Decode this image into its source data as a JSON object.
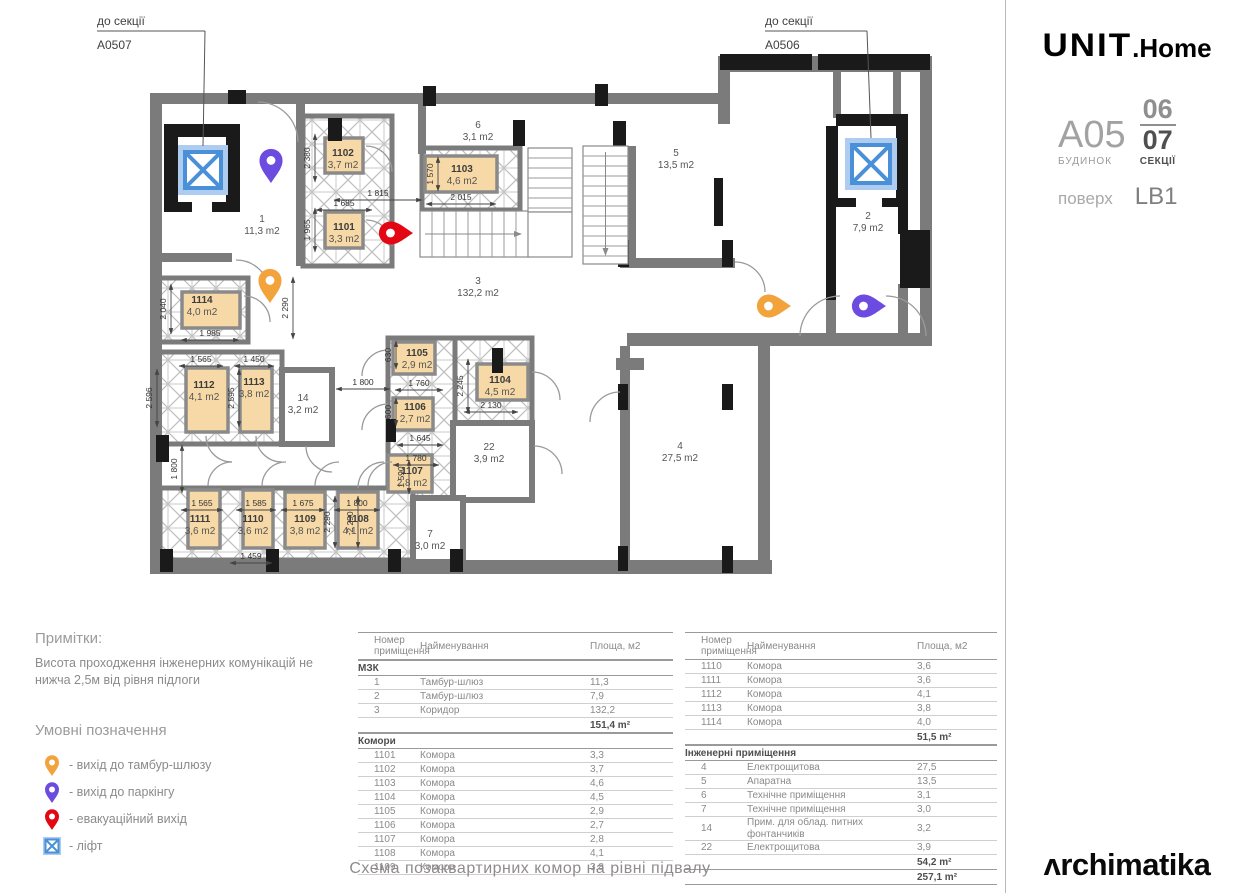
{
  "caption": "Схема позаквартирних комор на рівні підвалу",
  "colors": {
    "pin_orange": "#F2A33C",
    "pin_purple": "#6B4BE0",
    "pin_red": "#E30613",
    "lift_border": "#4A90D9",
    "lift_fill": "#AECBF0",
    "storage_fill": "#F6D9A6",
    "wall_gray": "#7B7B7B",
    "highlight": "#EF8763"
  },
  "notes": {
    "title": "Примітки:",
    "body": "Висота проходження інженерних комунікацій не нижча 2,5м від рівня підлоги"
  },
  "legend": {
    "title": "Умовні позначення",
    "items": [
      {
        "icon": "pin-orange",
        "label": "- вихід до тамбур-шлюзу"
      },
      {
        "icon": "pin-purple",
        "label": "- вихід до паркінгу"
      },
      {
        "icon": "pin-red",
        "label": "- евакуаційний вихід"
      },
      {
        "icon": "lift",
        "label": "- ліфт"
      }
    ]
  },
  "plan": {
    "leaders": [
      {
        "l1": "до секції",
        "l2": "A0507",
        "x": 97,
        "y": 25,
        "ux": 108,
        "tx": 203,
        "ty": 146
      },
      {
        "l1": "до секції",
        "l2": "A0506",
        "x": 765,
        "y": 25,
        "ux": 102,
        "tx": 871,
        "ty": 138
      }
    ],
    "rooms": [
      {
        "id": "1",
        "area": "11,3 m2",
        "x": 262,
        "y": 222
      },
      {
        "id": "2",
        "area": "7,9 m2",
        "x": 868,
        "y": 219
      },
      {
        "id": "3",
        "area": "132,2 m2",
        "x": 478,
        "y": 284
      },
      {
        "id": "4",
        "area": "27,5 m2",
        "x": 680,
        "y": 449
      },
      {
        "id": "5",
        "area": "13,5 m2",
        "x": 676,
        "y": 156
      },
      {
        "id": "6",
        "area": "3,1 m2",
        "x": 478,
        "y": 128
      },
      {
        "id": "7",
        "area": "3,0 m2",
        "x": 430,
        "y": 537
      },
      {
        "id": "14",
        "area": "3,2 m2",
        "x": 303,
        "y": 401
      },
      {
        "id": "22",
        "area": "3,9 m2",
        "x": 489,
        "y": 450
      },
      {
        "id": "1101",
        "area": "3,3 m2",
        "x": 344,
        "y": 230,
        "bold": true
      },
      {
        "id": "1102",
        "area": "3,7 m2",
        "x": 343,
        "y": 156,
        "bold": true
      },
      {
        "id": "1103",
        "area": "4,6 m2",
        "x": 462,
        "y": 172,
        "bold": true
      },
      {
        "id": "1104",
        "area": "4,5 m2",
        "x": 500,
        "y": 383,
        "bold": true
      },
      {
        "id": "1105",
        "area": "2,9 m2",
        "x": 417,
        "y": 356,
        "bold": true
      },
      {
        "id": "1106",
        "area": "2,7 m2",
        "x": 415,
        "y": 410,
        "bold": true
      },
      {
        "id": "1107",
        "area": "2,8 m2",
        "x": 412,
        "y": 474,
        "bold": true
      },
      {
        "id": "1108",
        "area": "4,1 m2",
        "x": 358,
        "y": 522,
        "bold": true
      },
      {
        "id": "1109",
        "area": "3,8 m2",
        "x": 305,
        "y": 522,
        "bold": true
      },
      {
        "id": "1110",
        "area": "3,6 m2",
        "x": 253,
        "y": 522,
        "bold": true
      },
      {
        "id": "1111",
        "area": "3,6 m2",
        "x": 200,
        "y": 522,
        "bold": true
      },
      {
        "id": "1112",
        "area": "4,1 m2",
        "x": 204,
        "y": 388,
        "bold": true
      },
      {
        "id": "1113",
        "area": "3,8 m2",
        "x": 254,
        "y": 385,
        "bold": true
      },
      {
        "id": "1114",
        "area": "4,0 m2",
        "x": 202,
        "y": 303,
        "bold": true
      }
    ],
    "dimensions": [
      {
        "text": "1 815",
        "x": 378,
        "y": 196,
        "rot": 0,
        "len": 88
      },
      {
        "text": "1 570",
        "x": 433,
        "y": 174,
        "rot": -90,
        "len": 34
      },
      {
        "text": "2 015",
        "x": 461,
        "y": 200,
        "rot": 0,
        "len": 70
      },
      {
        "text": "1 685",
        "x": 344,
        "y": 206,
        "rot": 0,
        "len": 56
      },
      {
        "text": "2 380",
        "x": 310,
        "y": 158,
        "rot": -90,
        "len": 48
      },
      {
        "text": "1 965",
        "x": 310,
        "y": 230,
        "rot": -90,
        "len": 44
      },
      {
        "text": "2 040",
        "x": 166,
        "y": 309,
        "rot": -90,
        "len": 50
      },
      {
        "text": "1 985",
        "x": 210,
        "y": 336,
        "rot": 0,
        "len": 58
      },
      {
        "text": "2 290",
        "x": 288,
        "y": 308,
        "rot": -90,
        "len": 62
      },
      {
        "text": "1 565",
        "x": 201,
        "y": 362,
        "rot": 0,
        "len": 44
      },
      {
        "text": "1 450",
        "x": 254,
        "y": 362,
        "rot": 0,
        "len": 40
      },
      {
        "text": "2 596",
        "x": 152,
        "y": 398,
        "rot": -90,
        "len": 58
      },
      {
        "text": "2 595",
        "x": 234,
        "y": 398,
        "rot": -90,
        "len": 58
      },
      {
        "text": "1 800",
        "x": 363,
        "y": 385,
        "rot": 0,
        "len": 54
      },
      {
        "text": "630",
        "x": 391,
        "y": 355,
        "rot": -90,
        "len": 28
      },
      {
        "text": "1 760",
        "x": 419,
        "y": 386,
        "rot": 0,
        "len": 48
      },
      {
        "text": "600",
        "x": 391,
        "y": 412,
        "rot": -90,
        "len": 28
      },
      {
        "text": "1 645",
        "x": 420,
        "y": 441,
        "rot": 0,
        "len": 46
      },
      {
        "text": "1 780",
        "x": 416,
        "y": 461,
        "rot": 0,
        "len": 46
      },
      {
        "text": "1 590",
        "x": 404,
        "y": 477,
        "rot": -90,
        "len": 34
      },
      {
        "text": "2 245",
        "x": 463,
        "y": 386,
        "rot": -90,
        "len": 54
      },
      {
        "text": "2 130",
        "x": 491,
        "y": 408,
        "rot": 0,
        "len": 54
      },
      {
        "text": "1 565",
        "x": 202,
        "y": 506,
        "rot": 0,
        "len": 42
      },
      {
        "text": "1 585",
        "x": 256,
        "y": 506,
        "rot": 0,
        "len": 40
      },
      {
        "text": "1 675",
        "x": 303,
        "y": 506,
        "rot": 0,
        "len": 44
      },
      {
        "text": "1 800",
        "x": 357,
        "y": 506,
        "rot": 0,
        "len": 46
      },
      {
        "text": "1 459",
        "x": 251,
        "y": 559,
        "rot": 0,
        "len": 42
      },
      {
        "text": "2 290",
        "x": 330,
        "y": 522,
        "rot": -90,
        "len": 52
      },
      {
        "text": "2 290",
        "x": 353,
        "y": 522,
        "rot": -90,
        "len": 52
      },
      {
        "text": "1 800",
        "x": 177,
        "y": 469,
        "rot": -90,
        "len": 48
      }
    ],
    "markers": [
      {
        "type": "lift",
        "x": 203,
        "y": 170,
        "s": 50
      },
      {
        "type": "lift",
        "x": 871,
        "y": 164,
        "s": 52
      },
      {
        "type": "pin",
        "color": "pin_purple",
        "x": 271,
        "y": 183,
        "dir": "down"
      },
      {
        "type": "pin",
        "color": "pin_orange",
        "x": 270,
        "y": 303,
        "dir": "down"
      },
      {
        "type": "pin",
        "color": "pin_red",
        "x": 413,
        "y": 233,
        "dir": "right"
      },
      {
        "type": "pin",
        "color": "pin_orange",
        "x": 791,
        "y": 306,
        "dir": "right"
      },
      {
        "type": "pin",
        "color": "pin_purple",
        "x": 886,
        "y": 306,
        "dir": "right"
      }
    ]
  },
  "tables": {
    "left": {
      "header": [
        "Номер приміщення",
        "Найменування",
        "Площа, м2"
      ],
      "rows": [
        {
          "t": "sec",
          "name": "МЗК"
        },
        {
          "t": "row",
          "num": "1",
          "name": "Тамбур-шлюз",
          "area": "11,3"
        },
        {
          "t": "row",
          "num": "2",
          "name": "Тамбур-шлюз",
          "area": "7,9"
        },
        {
          "t": "row",
          "num": "3",
          "name": "Коридор",
          "area": "132,2"
        },
        {
          "t": "total",
          "area": "151,4 m²"
        },
        {
          "t": "sec",
          "name": "Комори"
        },
        {
          "t": "row",
          "num": "1101",
          "name": "Комора",
          "area": "3,3"
        },
        {
          "t": "row",
          "num": "1102",
          "name": "Комора",
          "area": "3,7"
        },
        {
          "t": "row",
          "num": "1103",
          "name": "Комора",
          "area": "4,6"
        },
        {
          "t": "row",
          "num": "1104",
          "name": "Комора",
          "area": "4,5"
        },
        {
          "t": "row",
          "num": "1105",
          "name": "Комора",
          "area": "2,9"
        },
        {
          "t": "row",
          "num": "1106",
          "name": "Комора",
          "area": "2,7"
        },
        {
          "t": "row",
          "num": "1107",
          "name": "Комора",
          "area": "2,8"
        },
        {
          "t": "row",
          "num": "1108",
          "name": "Комора",
          "area": "4,1"
        },
        {
          "t": "row",
          "num": "1109",
          "name": "Комора",
          "area": "3,8"
        }
      ]
    },
    "right": {
      "header": [
        "Номер приміщення",
        "Найменування",
        "Площа, м2"
      ],
      "rows": [
        {
          "t": "row",
          "num": "1110",
          "name": "Комора",
          "area": "3,6"
        },
        {
          "t": "row",
          "num": "1111",
          "name": "Комора",
          "area": "3,6"
        },
        {
          "t": "row",
          "num": "1112",
          "name": "Комора",
          "area": "4,1"
        },
        {
          "t": "row",
          "num": "1113",
          "name": "Комора",
          "area": "3,8"
        },
        {
          "t": "row",
          "num": "1114",
          "name": "Комора",
          "area": "4,0"
        },
        {
          "t": "total",
          "area": "51,5 m²"
        },
        {
          "t": "sec",
          "name": "Інженерні приміщення"
        },
        {
          "t": "row",
          "num": "4",
          "name": "Електрощитова",
          "area": "27,5"
        },
        {
          "t": "row",
          "num": "5",
          "name": "Апаратна",
          "area": "13,5"
        },
        {
          "t": "row",
          "num": "6",
          "name": "Технічне приміщення",
          "area": "3,1"
        },
        {
          "t": "row",
          "num": "7",
          "name": "Технічне приміщення",
          "area": "3,0"
        },
        {
          "t": "row",
          "num": "14",
          "name": "Прим. для облад. питних фонтанчиків",
          "area": "3,2"
        },
        {
          "t": "row",
          "num": "22",
          "name": "Електрощитова",
          "area": "3,9"
        },
        {
          "t": "total",
          "area": "54,2 m²"
        },
        {
          "t": "grand",
          "area": "257,1 m²"
        }
      ]
    }
  },
  "sidebar": {
    "brand": {
      "unit": "UNIT",
      "home": ".Home"
    },
    "building": {
      "code": "A05",
      "code_label": "БУДИНОК",
      "sec_top": "06",
      "sec_bottom": "07",
      "sec_label": "СЕКЦІЇ",
      "floor_label": "поверх",
      "floor_value": "LB1"
    },
    "minimap": {
      "labels": [
        {
          "t": "Main Plaza",
          "x": 96,
          "y": 40,
          "s": 7.5,
          "c": "#9a9a9a"
        },
        {
          "t": "A0503",
          "x": 42,
          "y": 72,
          "s": 7.5,
          "c": "#3f3f3f",
          "b": 1
        },
        {
          "t": "A05",
          "x": 38,
          "y": 112,
          "s": 17,
          "c": "#8a8a8a"
        },
        {
          "t": "A0504",
          "x": 121,
          "y": 84,
          "s": 7.5,
          "c": "#555",
          "rot": 40
        },
        {
          "t": "A0502",
          "x": 39,
          "y": 162,
          "s": 7.5,
          "c": "#3f3f3f",
          "rot": -90
        },
        {
          "t": "A0601",
          "x": 39,
          "y": 210,
          "s": 7.5,
          "c": "#3f3f3f",
          "rot": -90
        },
        {
          "t": "A0505",
          "x": 172,
          "y": 178,
          "s": 7.5,
          "c": "#3f3f3f",
          "rot": -90
        },
        {
          "t": "A0507",
          "x": 103,
          "y": 196,
          "s": 7.5,
          "c": "#C0714B"
        },
        {
          "t": "A0506",
          "x": 142,
          "y": 196,
          "s": 7.5,
          "c": "#8a8a8a"
        },
        {
          "t": "A07",
          "x": 98,
          "y": 241,
          "s": 7.5,
          "c": "#9a9a9a"
        }
      ]
    },
    "album": {
      "title": "ІНВЕСТИЦІЙНИЙ АЛЬБОМ",
      "body": "«Будівництво житлово-офісного комплексу з об’єктами торгово-розважальної, ринкової, соціальної інфраструктури та паркінгами на вул. Сім’ї Хохлових, 8 у Шевченківському районі міста Києва». 1 черга будівництва"
    },
    "logo": "ʌrchimatika"
  }
}
